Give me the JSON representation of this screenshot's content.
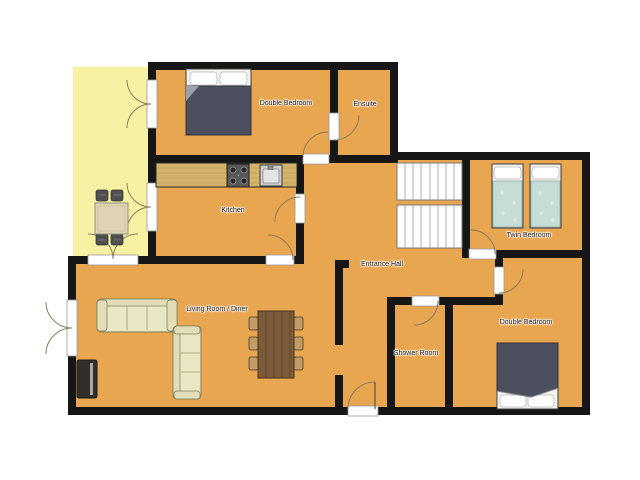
{
  "meta": {
    "view": "floor-plan",
    "background": "#ffffff"
  },
  "colors": {
    "floor": "#e9a651",
    "terrace": "#f7f1a3",
    "wall": "#161616",
    "threshold": "#ffffff",
    "stair_tread": "#ffffff",
    "counter": "#d4b46c",
    "bed_frame": "#f4f3ee",
    "bed_duvet_dark": "#4b4f5e",
    "twin_blanket": "#c6dcd6",
    "sofa": "#eae7c4",
    "sofa_trim": "#e0ddb8",
    "dining_table": "#7b5b39",
    "dining_chair": "#c19c67",
    "patio_table": "#ded4b4",
    "patio_chair": "#4f4f4f",
    "tv_body": "#332e28",
    "door_arc": "#8a7a5c"
  },
  "rooms": {
    "double_bedroom_top": {
      "label": "Double Bedroom"
    },
    "ensuite": {
      "label": "Ensuite"
    },
    "kitchen": {
      "label": "Kitchen"
    },
    "entrance_hall": {
      "label": "Entrance Hall"
    },
    "twin_bedroom": {
      "label": "Twin Bedroom"
    },
    "living_room_diner": {
      "label": "Living Room / Diner"
    },
    "shower_room": {
      "label": "Shower Room"
    },
    "double_bedroom_bottom": {
      "label": "Double Bedroom"
    }
  },
  "icons": [
    "double-bed-icon",
    "twin-bed-icon",
    "kitchen-counter-icon",
    "stove-icon",
    "sink-icon",
    "stairs-icon",
    "sofa-icon",
    "tv-icon",
    "dining-table-icon",
    "chair-icon",
    "patio-table-icon",
    "patio-chair-icon",
    "door-swing-icon",
    "french-door-icon"
  ]
}
